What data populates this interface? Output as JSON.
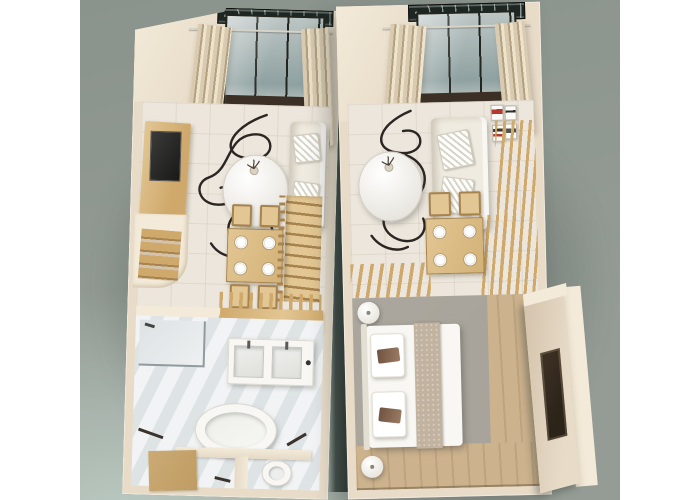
{
  "scene": {
    "type": "3d-floor-plan-render",
    "subject": "Two dollhouse-style 3D floor plans of a duplex studio apartment viewed from above, side by side on a sage backdrop with white page margins",
    "plans": [
      {
        "name": "lower-level-plan",
        "position": "left",
        "areas": [
          "juliet-balcony",
          "living-room",
          "dining-area",
          "staircase",
          "bathroom"
        ],
        "objects": [
          "wrought-iron-railing",
          "glass-wall",
          "curtains",
          "curtain-rod",
          "tv-cabinet",
          "wall-shelves",
          "wire-decor-rug",
          "round-table",
          "plant",
          "sofa",
          "throw-pillows",
          "dining-table",
          "dining-chairs",
          "place-settings",
          "wood-stairs",
          "stair-balustrade",
          "wood-slat-screen",
          "wood-landing",
          "shower",
          "double-sink-vanity",
          "freestanding-bathtub",
          "toilet",
          "partition-wall",
          "bath-mat",
          "towel-rails"
        ]
      },
      {
        "name": "upper-level-plan",
        "position": "right",
        "areas": [
          "juliet-balcony",
          "living-room",
          "dining-area",
          "stair-void",
          "bedroom",
          "entry"
        ],
        "objects": [
          "wrought-iron-railing",
          "glass-wall",
          "curtains",
          "curtain-rod",
          "wire-decor-rug",
          "round-table",
          "plant",
          "sofa",
          "throw-pillows",
          "gallery-wall-art",
          "wood-slat-partition",
          "dining-table",
          "dining-chairs",
          "place-settings",
          "double-bed",
          "bed-runner",
          "bed-pillows",
          "round-nightstands",
          "tv-wall-panel",
          "wood-floor"
        ]
      }
    ]
  },
  "colors": {
    "page_margin": "#ffffff",
    "backdrop_top": "#8b938d",
    "backdrop_mid": "#949c95",
    "backdrop_glow": "#b9c8c0",
    "dark_gap": "#2c3834",
    "wall": "#e8dcc9",
    "wall_bright": "#f3ead9",
    "wall_shade": "#d4c3ac",
    "glass": "#bcc6c4",
    "glass_deep": "#8fa1a1",
    "frame_black": "#23251f",
    "sill_brown": "#3c2f25",
    "iron_dark": "#1d2623",
    "curtain": "#d9cbb1",
    "curtain_shade": "#b3a181",
    "wood": "#cfa96b",
    "wood_light": "#e2c693",
    "wood_dark": "#a7834e",
    "floor_main": "#ece6dc",
    "floor_bath": "#e7eaeb",
    "floor_bed": "#a8a49b",
    "floor_wood": "#ccb28d",
    "line_dark": "#2b2523",
    "white_obj": "#f8f7f3",
    "sofa": "#f0ebe0",
    "runner": "#c2b3a0",
    "pillow_accent": "#6f5240",
    "accent_art": "#b23a30",
    "tv_dark": "#2a2927",
    "tv_brown": "#3f3326",
    "shadow": "rgba(44,54,49,0.42)"
  }
}
